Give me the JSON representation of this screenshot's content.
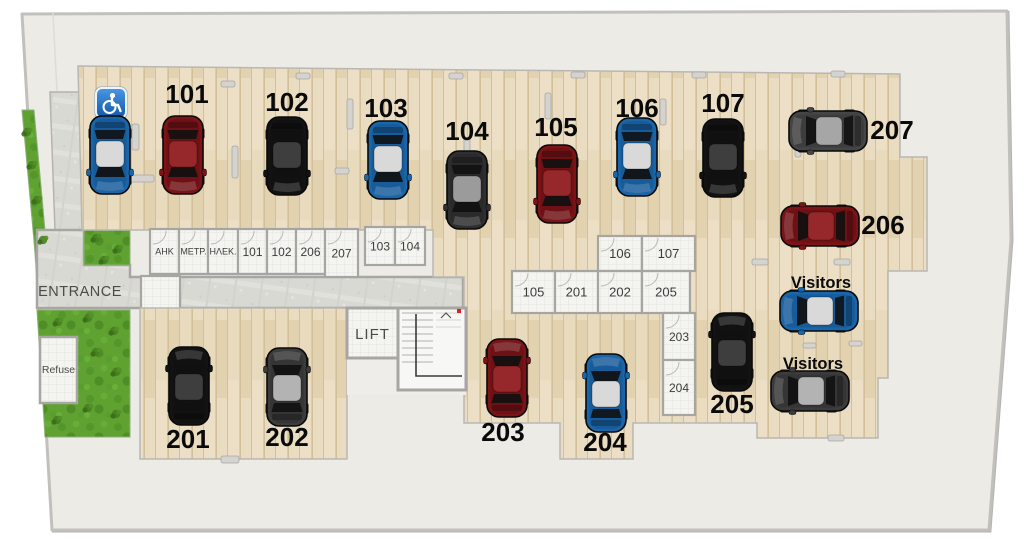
{
  "plan": {
    "entrance_label": "ENTRANCE",
    "lift_label": "LIFT",
    "refuse_label": "Refuse",
    "accessible_icon": "wheelchair",
    "colors": {
      "floor_wood": "#e8dabc",
      "site_background": "#edebe6",
      "stone_path": "#d9d9d4",
      "grass": "#5fa232",
      "accessible_blue": "#2a7fd0",
      "car_maroon": "#7c1317",
      "car_black": "#131313",
      "car_blue": "#1a66ab",
      "car_gray": "#454545"
    }
  },
  "storage_rooms": [
    {
      "label": "ΑΗΚ",
      "x": 150,
      "y": 229,
      "w": 29,
      "h": 45,
      "fs": 9
    },
    {
      "label": "ΜΕΤΡ.",
      "x": 179,
      "y": 229,
      "w": 29,
      "h": 45,
      "fs": 9
    },
    {
      "label": "ΗΛΕΚ.",
      "x": 208,
      "y": 229,
      "w": 30,
      "h": 45,
      "fs": 9
    },
    {
      "label": "101",
      "x": 238,
      "y": 229,
      "w": 29,
      "h": 45,
      "fs": 12
    },
    {
      "label": "102",
      "x": 267,
      "y": 229,
      "w": 29,
      "h": 45,
      "fs": 12
    },
    {
      "label": "206",
      "x": 296,
      "y": 229,
      "w": 29,
      "h": 45,
      "fs": 12
    },
    {
      "label": "207",
      "x": 325,
      "y": 229,
      "w": 33,
      "h": 48,
      "fs": 12
    },
    {
      "label": "103",
      "x": 365,
      "y": 227,
      "w": 30,
      "h": 38,
      "fs": 12
    },
    {
      "label": "104",
      "x": 395,
      "y": 227,
      "w": 30,
      "h": 38,
      "fs": 12
    },
    {
      "label": "106",
      "x": 598,
      "y": 236,
      "w": 44,
      "h": 35,
      "fs": 13
    },
    {
      "label": "107",
      "x": 642,
      "y": 236,
      "w": 53,
      "h": 35,
      "fs": 13
    },
    {
      "label": "105",
      "x": 512,
      "y": 271,
      "w": 43,
      "h": 42,
      "fs": 13
    },
    {
      "label": "201",
      "x": 555,
      "y": 271,
      "w": 43,
      "h": 42,
      "fs": 13
    },
    {
      "label": "202",
      "x": 598,
      "y": 271,
      "w": 44,
      "h": 42,
      "fs": 13
    },
    {
      "label": "205",
      "x": 642,
      "y": 271,
      "w": 48,
      "h": 42,
      "fs": 13
    },
    {
      "label": "203",
      "x": 663,
      "y": 313,
      "w": 32,
      "h": 47,
      "fs": 12
    },
    {
      "label": "204",
      "x": 663,
      "y": 360,
      "w": 32,
      "h": 55,
      "fs": 12
    }
  ],
  "parking_labels": [
    {
      "text": "101",
      "x": 187,
      "y": 103
    },
    {
      "text": "102",
      "x": 287,
      "y": 111
    },
    {
      "text": "103",
      "x": 386,
      "y": 117
    },
    {
      "text": "104",
      "x": 467,
      "y": 140
    },
    {
      "text": "105",
      "x": 556,
      "y": 136
    },
    {
      "text": "106",
      "x": 637,
      "y": 117
    },
    {
      "text": "107",
      "x": 723,
      "y": 112
    },
    {
      "text": "207",
      "x": 892,
      "y": 139
    },
    {
      "text": "206",
      "x": 883,
      "y": 234
    },
    {
      "text": "Visitors",
      "x": 821,
      "y": 288,
      "small": true
    },
    {
      "text": "Visitors",
      "x": 813,
      "y": 369,
      "small": true
    },
    {
      "text": "201",
      "x": 188,
      "y": 448
    },
    {
      "text": "202",
      "x": 287,
      "y": 446
    },
    {
      "text": "203",
      "x": 503,
      "y": 441
    },
    {
      "text": "204",
      "x": 605,
      "y": 451
    },
    {
      "text": "205",
      "x": 732,
      "y": 413
    }
  ],
  "cars": [
    {
      "spot": "accessible",
      "x": 110,
      "y": 155,
      "rot": 180,
      "body": "#1a66ab",
      "roof": "#d9d9d9"
    },
    {
      "spot": "101",
      "x": 183,
      "y": 155,
      "rot": 180,
      "body": "#7c1317",
      "roof": "#96272b"
    },
    {
      "spot": "102",
      "x": 287,
      "y": 156,
      "rot": 180,
      "body": "#131313",
      "roof": "#3e3e3e"
    },
    {
      "spot": "103",
      "x": 388,
      "y": 160,
      "rot": 180,
      "body": "#1a66ab",
      "roof": "#d9d9d9"
    },
    {
      "spot": "104",
      "x": 467,
      "y": 190,
      "rot": 180,
      "body": "#2f2f2f",
      "roof": "#9b9b9b"
    },
    {
      "spot": "105",
      "x": 557,
      "y": 184,
      "rot": 180,
      "body": "#7c1317",
      "roof": "#96272b"
    },
    {
      "spot": "106",
      "x": 637,
      "y": 157,
      "rot": 180,
      "body": "#1a66ab",
      "roof": "#d9d9d9"
    },
    {
      "spot": "107",
      "x": 723,
      "y": 158,
      "rot": 180,
      "body": "#131313",
      "roof": "#3e3e3e"
    },
    {
      "spot": "207",
      "x": 828,
      "y": 131,
      "rot": -90,
      "body": "#454545",
      "roof": "#a6a6a6"
    },
    {
      "spot": "206",
      "x": 820,
      "y": 226,
      "rot": -90,
      "body": "#7c1317",
      "roof": "#96272b"
    },
    {
      "spot": "Visitors",
      "x": 819,
      "y": 311,
      "rot": -90,
      "body": "#1a66ab",
      "roof": "#d9d9d9"
    },
    {
      "spot": "Visitors",
      "x": 810,
      "y": 391,
      "rot": -90,
      "body": "#3c3c3c",
      "roof": "#b3b3b3"
    },
    {
      "spot": "201",
      "x": 189,
      "y": 386,
      "rot": 0,
      "body": "#131313",
      "roof": "#3e3e3e"
    },
    {
      "spot": "202",
      "x": 287,
      "y": 387,
      "rot": 0,
      "body": "#3c3c3c",
      "roof": "#b3b3b3"
    },
    {
      "spot": "203",
      "x": 507,
      "y": 378,
      "rot": 0,
      "body": "#7c1317",
      "roof": "#96272b"
    },
    {
      "spot": "204",
      "x": 606,
      "y": 393,
      "rot": 0,
      "body": "#1a66ab",
      "roof": "#d9d9d9"
    },
    {
      "spot": "205",
      "x": 732,
      "y": 352,
      "rot": 0,
      "body": "#131313",
      "roof": "#3e3e3e"
    }
  ]
}
